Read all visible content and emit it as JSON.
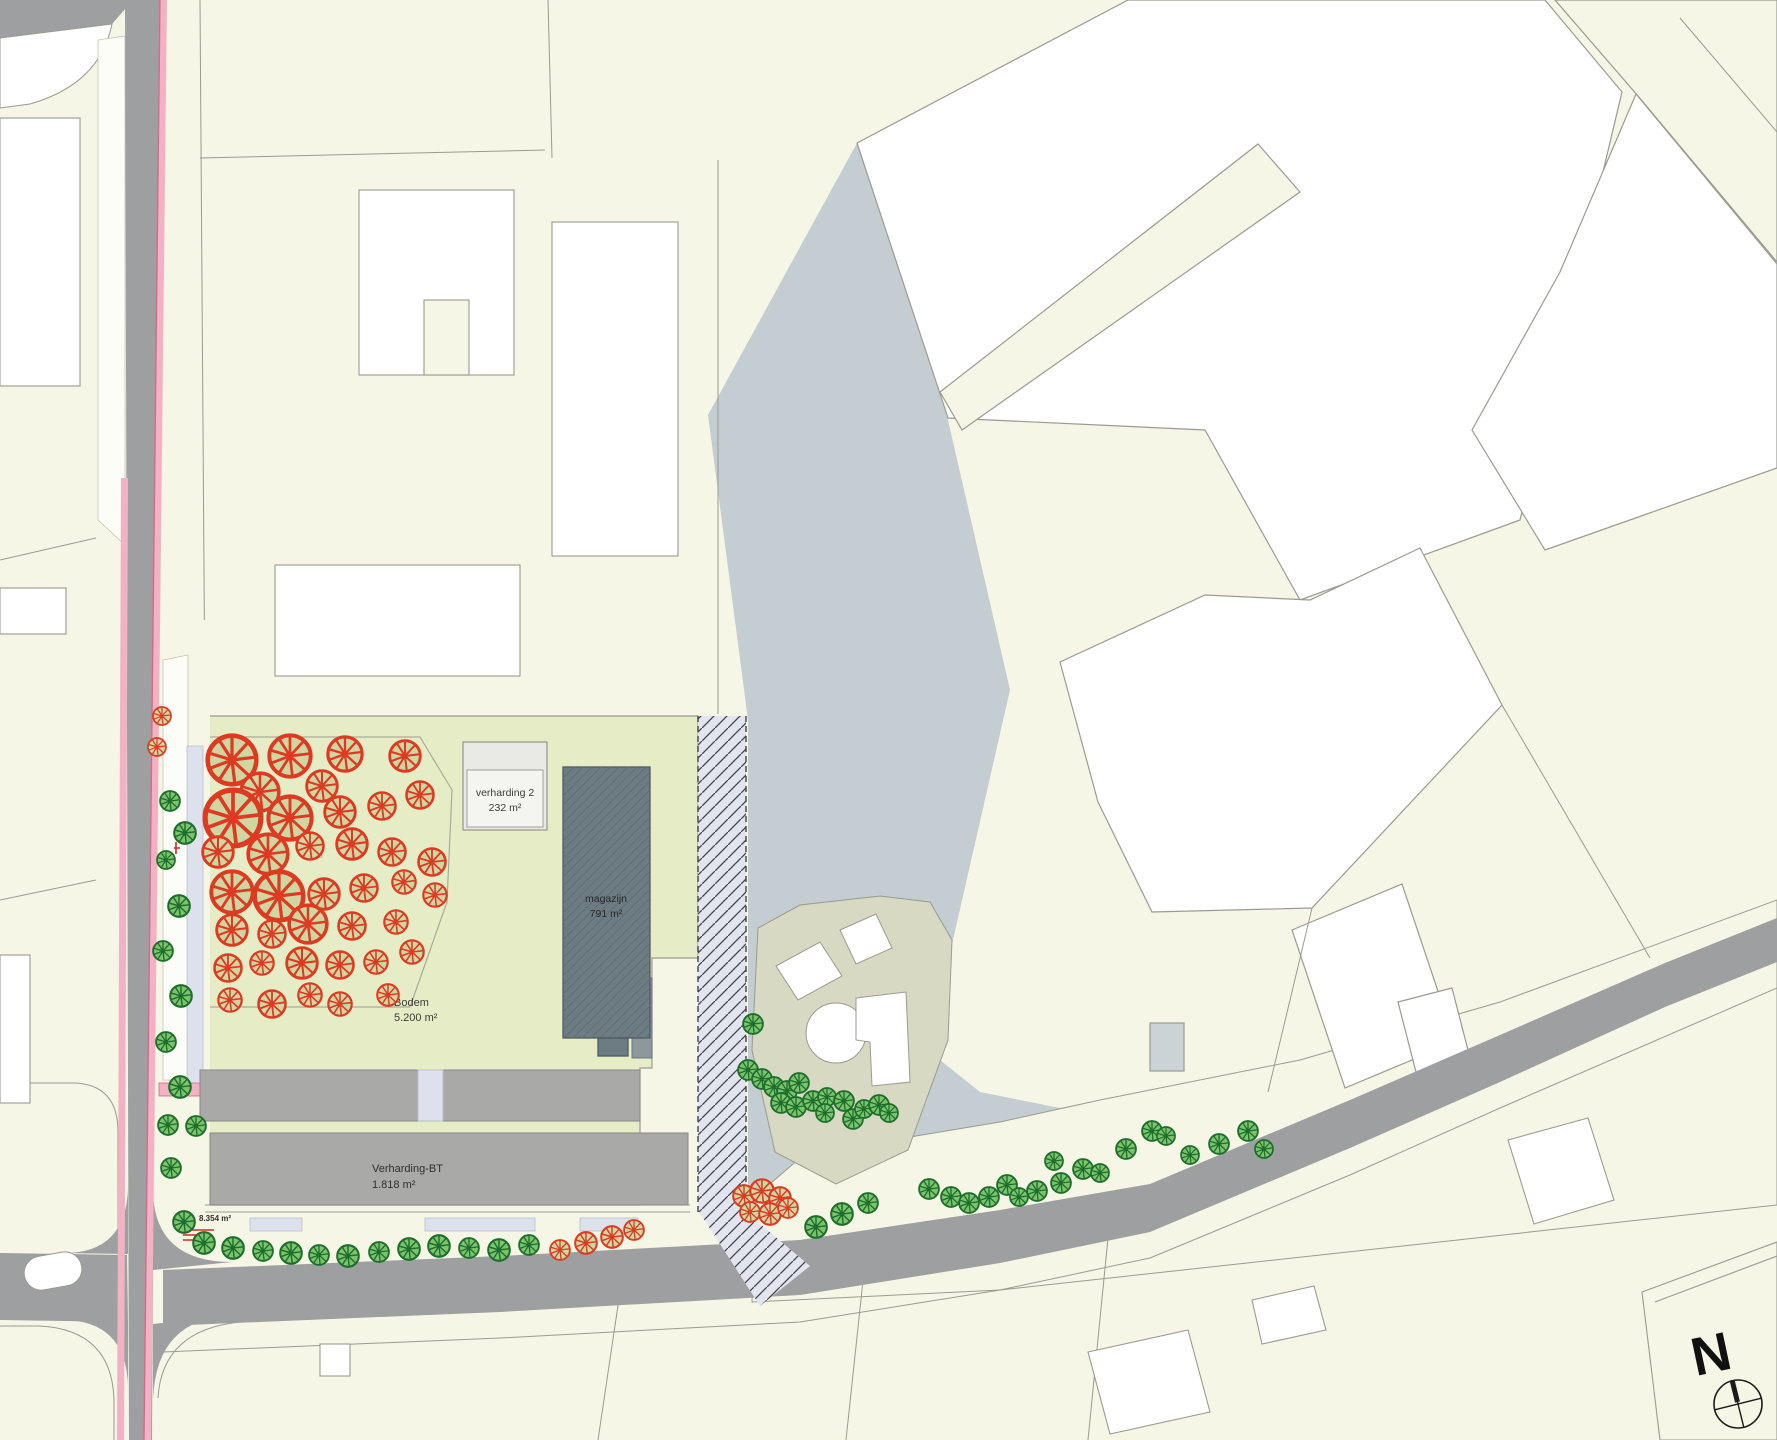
{
  "map": {
    "labels": {
      "bos": "BOS",
      "verharding2_title": "verharding 2",
      "verharding2_area": "232 m²",
      "magazijn_title": "magazijn",
      "magazijn_area": "791 m²",
      "bodem_title": "Bodem",
      "bodem_area": "5.200 m²",
      "verharding_bt_title": "Verharding-BT",
      "verharding_bt_area": "1.818 m²",
      "corner_area": "8.354 m²",
      "north": "N"
    },
    "colors": {
      "cream": "#f6f6e6",
      "pale_green": "#e6edc6",
      "blue_gray": "#c4cdd1",
      "road_gray": "#9d9fa0",
      "park_gray": "#a9a9a7",
      "dark_park": "#8d989d",
      "dark_building": "#6d7b82",
      "beige": "#d8d9c3",
      "white": "#ffffff",
      "line": "#9a9b90",
      "pink": "#f3b2c4",
      "pink_line": "#d4688a",
      "hatch_fill": "#e2e4ee",
      "hatch_line": "#42424e",
      "lavender": "#dde1ec",
      "text_dark": "#3a3a38",
      "bos_text": "#b2b58e",
      "red_note": "#e02020",
      "tree_green_fill": "#7cc46c",
      "tree_green_stroke": "#1d6e2d",
      "tree_red_fill": "#cfd6a2",
      "tree_red_stroke": "#dd3a22"
    },
    "trees": {
      "red": [
        [
          232,
          760,
          27
        ],
        [
          290,
          756,
          23
        ],
        [
          345,
          754,
          19
        ],
        [
          405,
          756,
          17
        ],
        [
          260,
          792,
          21
        ],
        [
          322,
          786,
          17
        ],
        [
          233,
          818,
          31
        ],
        [
          290,
          818,
          24
        ],
        [
          340,
          812,
          17
        ],
        [
          382,
          806,
          15
        ],
        [
          420,
          795,
          15
        ],
        [
          218,
          852,
          17
        ],
        [
          268,
          854,
          22
        ],
        [
          310,
          846,
          15
        ],
        [
          352,
          844,
          17
        ],
        [
          392,
          852,
          15
        ],
        [
          432,
          862,
          15
        ],
        [
          232,
          892,
          23
        ],
        [
          279,
          896,
          27
        ],
        [
          324,
          894,
          17
        ],
        [
          364,
          888,
          15
        ],
        [
          404,
          882,
          13
        ],
        [
          232,
          930,
          17
        ],
        [
          272,
          934,
          15
        ],
        [
          308,
          924,
          21
        ],
        [
          352,
          926,
          15
        ],
        [
          396,
          922,
          13
        ],
        [
          435,
          895,
          13
        ],
        [
          228,
          968,
          15
        ],
        [
          262,
          963,
          13
        ],
        [
          302,
          963,
          17
        ],
        [
          340,
          965,
          15
        ],
        [
          376,
          962,
          13
        ],
        [
          412,
          952,
          13
        ],
        [
          230,
          1000,
          13
        ],
        [
          272,
          1004,
          15
        ],
        [
          340,
          1004,
          13
        ],
        [
          388,
          995,
          12
        ],
        [
          310,
          995,
          13
        ],
        [
          162,
          716,
          10
        ],
        [
          157,
          747,
          10
        ],
        [
          560,
          1250,
          11
        ],
        [
          586,
          1243,
          12
        ],
        [
          612,
          1237,
          12
        ],
        [
          634,
          1230,
          11
        ],
        [
          744,
          1196,
          12
        ],
        [
          762,
          1191,
          13
        ],
        [
          780,
          1198,
          12
        ],
        [
          750,
          1212,
          11
        ],
        [
          770,
          1214,
          12
        ],
        [
          788,
          1208,
          11
        ]
      ],
      "green": [
        [
          170,
          801,
          11
        ],
        [
          185,
          833,
          12
        ],
        [
          166,
          860,
          10
        ],
        [
          179,
          906,
          12
        ],
        [
          163,
          951,
          11
        ],
        [
          181,
          996,
          12
        ],
        [
          166,
          1042,
          11
        ],
        [
          180,
          1087,
          12
        ],
        [
          168,
          1125,
          11
        ],
        [
          196,
          1126,
          11
        ],
        [
          171,
          1168,
          11
        ],
        [
          184,
          1222,
          12
        ],
        [
          204,
          1243,
          12
        ],
        [
          233,
          1248,
          12
        ],
        [
          263,
          1251,
          11
        ],
        [
          291,
          1253,
          12
        ],
        [
          319,
          1255,
          11
        ],
        [
          348,
          1256,
          12
        ],
        [
          379,
          1252,
          11
        ],
        [
          409,
          1249,
          12
        ],
        [
          439,
          1246,
          12
        ],
        [
          469,
          1248,
          11
        ],
        [
          499,
          1250,
          12
        ],
        [
          529,
          1245,
          11
        ],
        [
          816,
          1227,
          12
        ],
        [
          842,
          1214,
          12
        ],
        [
          868,
          1203,
          11
        ],
        [
          753,
          1024,
          11
        ],
        [
          748,
          1070,
          11
        ],
        [
          762,
          1079,
          11
        ],
        [
          774,
          1087,
          11
        ],
        [
          787,
          1091,
          11
        ],
        [
          799,
          1083,
          11
        ],
        [
          781,
          1103,
          11
        ],
        [
          796,
          1107,
          11
        ],
        [
          813,
          1101,
          11
        ],
        [
          827,
          1097,
          10
        ],
        [
          825,
          1113,
          10
        ],
        [
          844,
          1101,
          11
        ],
        [
          853,
          1119,
          11
        ],
        [
          864,
          1109,
          10
        ],
        [
          879,
          1105,
          11
        ],
        [
          889,
          1113,
          10
        ],
        [
          929,
          1189,
          11
        ],
        [
          951,
          1197,
          11
        ],
        [
          969,
          1203,
          11
        ],
        [
          989,
          1197,
          11
        ],
        [
          1007,
          1185,
          11
        ],
        [
          1019,
          1197,
          10
        ],
        [
          1037,
          1191,
          11
        ],
        [
          1061,
          1183,
          11
        ],
        [
          1083,
          1169,
          11
        ],
        [
          1054,
          1161,
          10
        ],
        [
          1100,
          1173,
          10
        ],
        [
          1126,
          1149,
          11
        ],
        [
          1152,
          1131,
          11
        ],
        [
          1166,
          1136,
          10
        ],
        [
          1219,
          1144,
          11
        ],
        [
          1248,
          1131,
          11
        ],
        [
          1264,
          1149,
          10
        ],
        [
          1190,
          1155,
          10
        ]
      ]
    }
  }
}
